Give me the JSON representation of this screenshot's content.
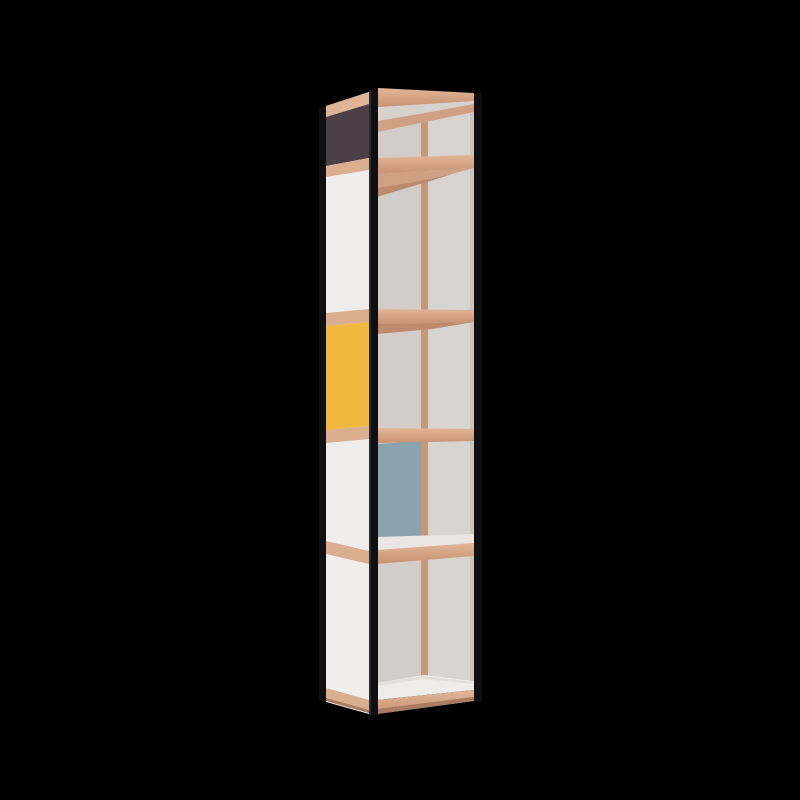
{
  "scene": {
    "description": "3D product render of a tall narrow five-compartment shelving tower viewed from its front-left corner on a black background",
    "object": "shelf-tower",
    "compartment_count": "5",
    "side_panel_sequence": "purple, white, yellow, white, white (top to bottom, separated by wood strips)",
    "interior_accent": "blue panel inside fourth compartment",
    "frame": "black vertical edge posts with wood shelves and rails"
  },
  "colors": {
    "background": "#000000",
    "frame_black": "#0f0f11",
    "frame_sheen": "#2b2b2e",
    "wood_band_top": "#e2b697",
    "wood_band_bottom": "#c79273",
    "wood_side_strip": "#dcae90",
    "wood_top_band": "#e0b496",
    "wood_underside": "#bd8a6e",
    "wood_back_rail": "#cfa083",
    "wood_seam": "#c5977b",
    "wood_base_shadow": "#aa7b63",
    "panel_white": "#f0eeec",
    "panel_purple": "#4c3f48",
    "panel_yellow": "#f0b83c",
    "panel_blue": "#8ba3af",
    "interior_left": "#d2cdc9",
    "interior_right": "#d8d4d0",
    "interior_sliver": "#c9c4c0",
    "top_underside": "#d7d2ce",
    "shelf_top_strip": "#e9e6e3",
    "floor": "#efedea",
    "floor_back": "#e3e0dc"
  }
}
